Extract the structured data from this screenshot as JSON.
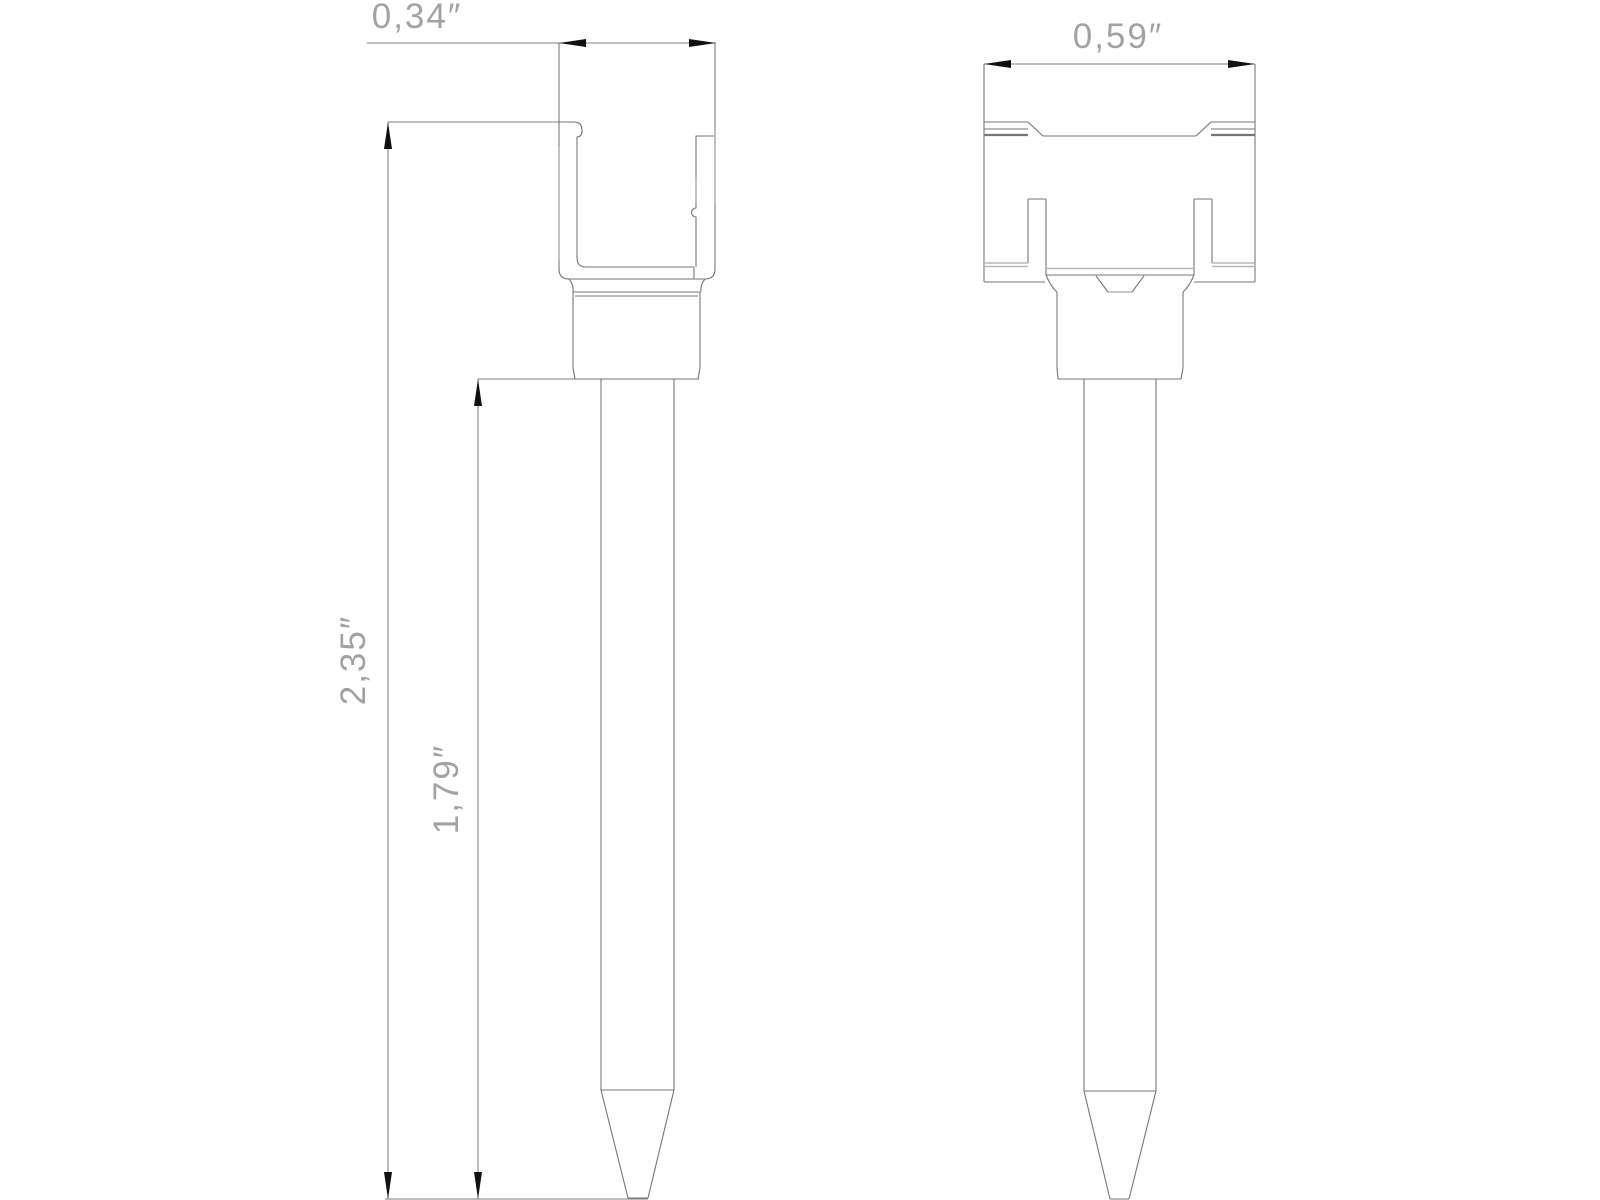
{
  "colors": {
    "line": "#767676",
    "line_light": "#b7b7b7",
    "dim_line": "#7d7d7d",
    "arrow": "#111111",
    "text": "#a2a2a2",
    "background": "#ffffff"
  },
  "dimensions": {
    "front_width": {
      "label": "0,34″"
    },
    "side_width": {
      "label": "0,59″"
    },
    "overall_height": {
      "label": "2,35″"
    },
    "pin_height": {
      "label": "1,79″"
    }
  }
}
